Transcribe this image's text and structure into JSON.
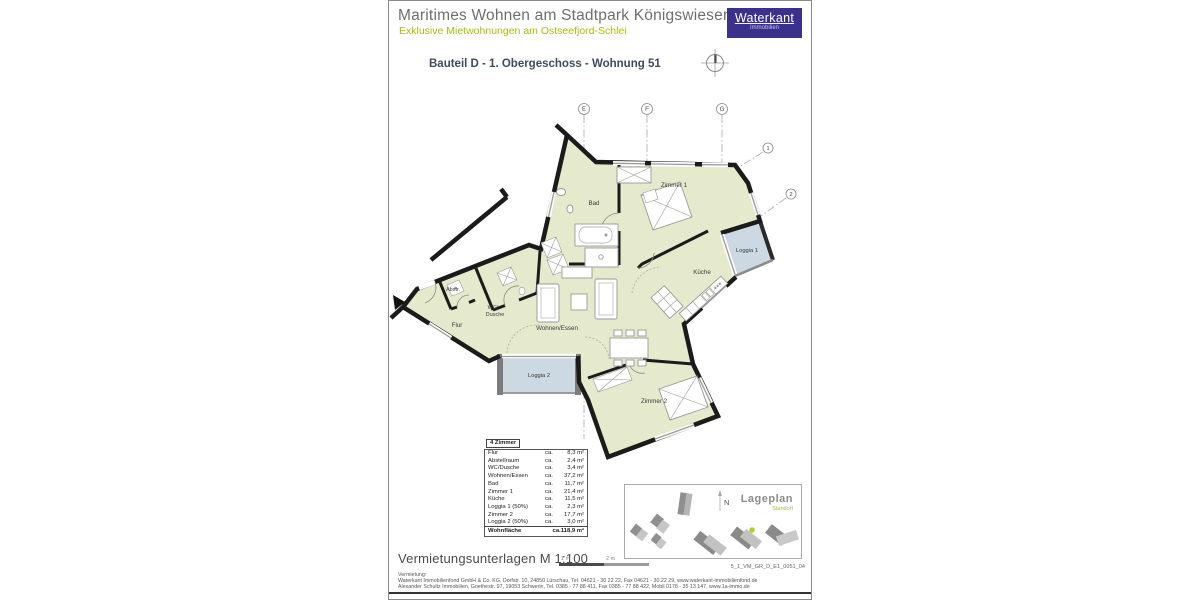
{
  "header": {
    "title": "Maritimes Wohnen am Stadtpark Königswiesen",
    "subtitle": "Exklusive Mietwohnungen am Ostseefjord-Schlei",
    "logo_name": "Waterkant",
    "logo_tagline": "Immobilien",
    "logo_color": "#39318c",
    "plan_title": "Bauteil D - 1. Obergeschoss - Wohnung 51"
  },
  "floorplan": {
    "grid": {
      "e": "E",
      "f": "F",
      "g": "G"
    },
    "markers": {
      "m1": "1",
      "m2": "2"
    },
    "rooms": {
      "zimmer1": "Zimmer 1",
      "bad": "Bad",
      "kueche": "Küche",
      "loggia1": "Loggia 1",
      "wohnen_essen": "Wohnen/Essen",
      "flur": "Flur",
      "abstellraum": "Abstr.",
      "wc_line1": "WC/",
      "wc_line2": "Dusche",
      "loggia2": "Loggia 2",
      "zimmer2": "Zimmer 2"
    },
    "colors": {
      "interior": "#e6eacc",
      "loggia": "#ccd9e2",
      "wall": "#1b1b1b"
    }
  },
  "area_table": {
    "header": "4 Zimmer",
    "approx": "ca.",
    "rows": [
      {
        "label": "Flur",
        "value": "8,3 m²"
      },
      {
        "label": "Abstellraum",
        "value": "2,4 m²"
      },
      {
        "label": "WC/Dusche",
        "value": "3,4 m²"
      },
      {
        "label": "Wohnen/Essen",
        "value": "37,2 m²"
      },
      {
        "label": "Bad",
        "value": "11,7 m²"
      },
      {
        "label": "Zimmer 1",
        "value": "21,4 m²"
      },
      {
        "label": "Küche",
        "value": "11,5 m²"
      },
      {
        "label": "Loggia 1 (50%)",
        "value": "2,3 m²"
      },
      {
        "label": "Zimmer 2",
        "value": "17,7 m²"
      },
      {
        "label": "Loggia 2 (50%)",
        "value": "3,0 m²"
      }
    ],
    "total_label": "Wohnfläche",
    "total_value": "ca.118,9 m²"
  },
  "siteplan": {
    "title": "Lageplan",
    "subtitle": "Standort",
    "north": "N",
    "marker_color": "#b5cb30"
  },
  "footer": {
    "doc_type": "Vermietungsunterlagen M 1:100",
    "scale_1": "1 m",
    "scale_2": "2 m",
    "doc_code": "5_1_VM_GR_D_E1_0051_04",
    "contact_heading": "Vermietung:",
    "contact_line1": "Waterkant Immobilienfond GmbH & Co. KG, Dorfstr. 10, 24850 Lürschau, Tel. 04621 - 30 22 22, Fax 04621 - 30 22 29, www.waterkant-immobilienfond.de",
    "contact_line2": "Alexander Schultz Immobilien, Goethestr. 97, 19053 Schwerin, Tel. 0385 - 77 88 411, Fax 0385 - 77 88 422, Mobil 0178 - 35 13 147, www.1a-immo.de"
  }
}
